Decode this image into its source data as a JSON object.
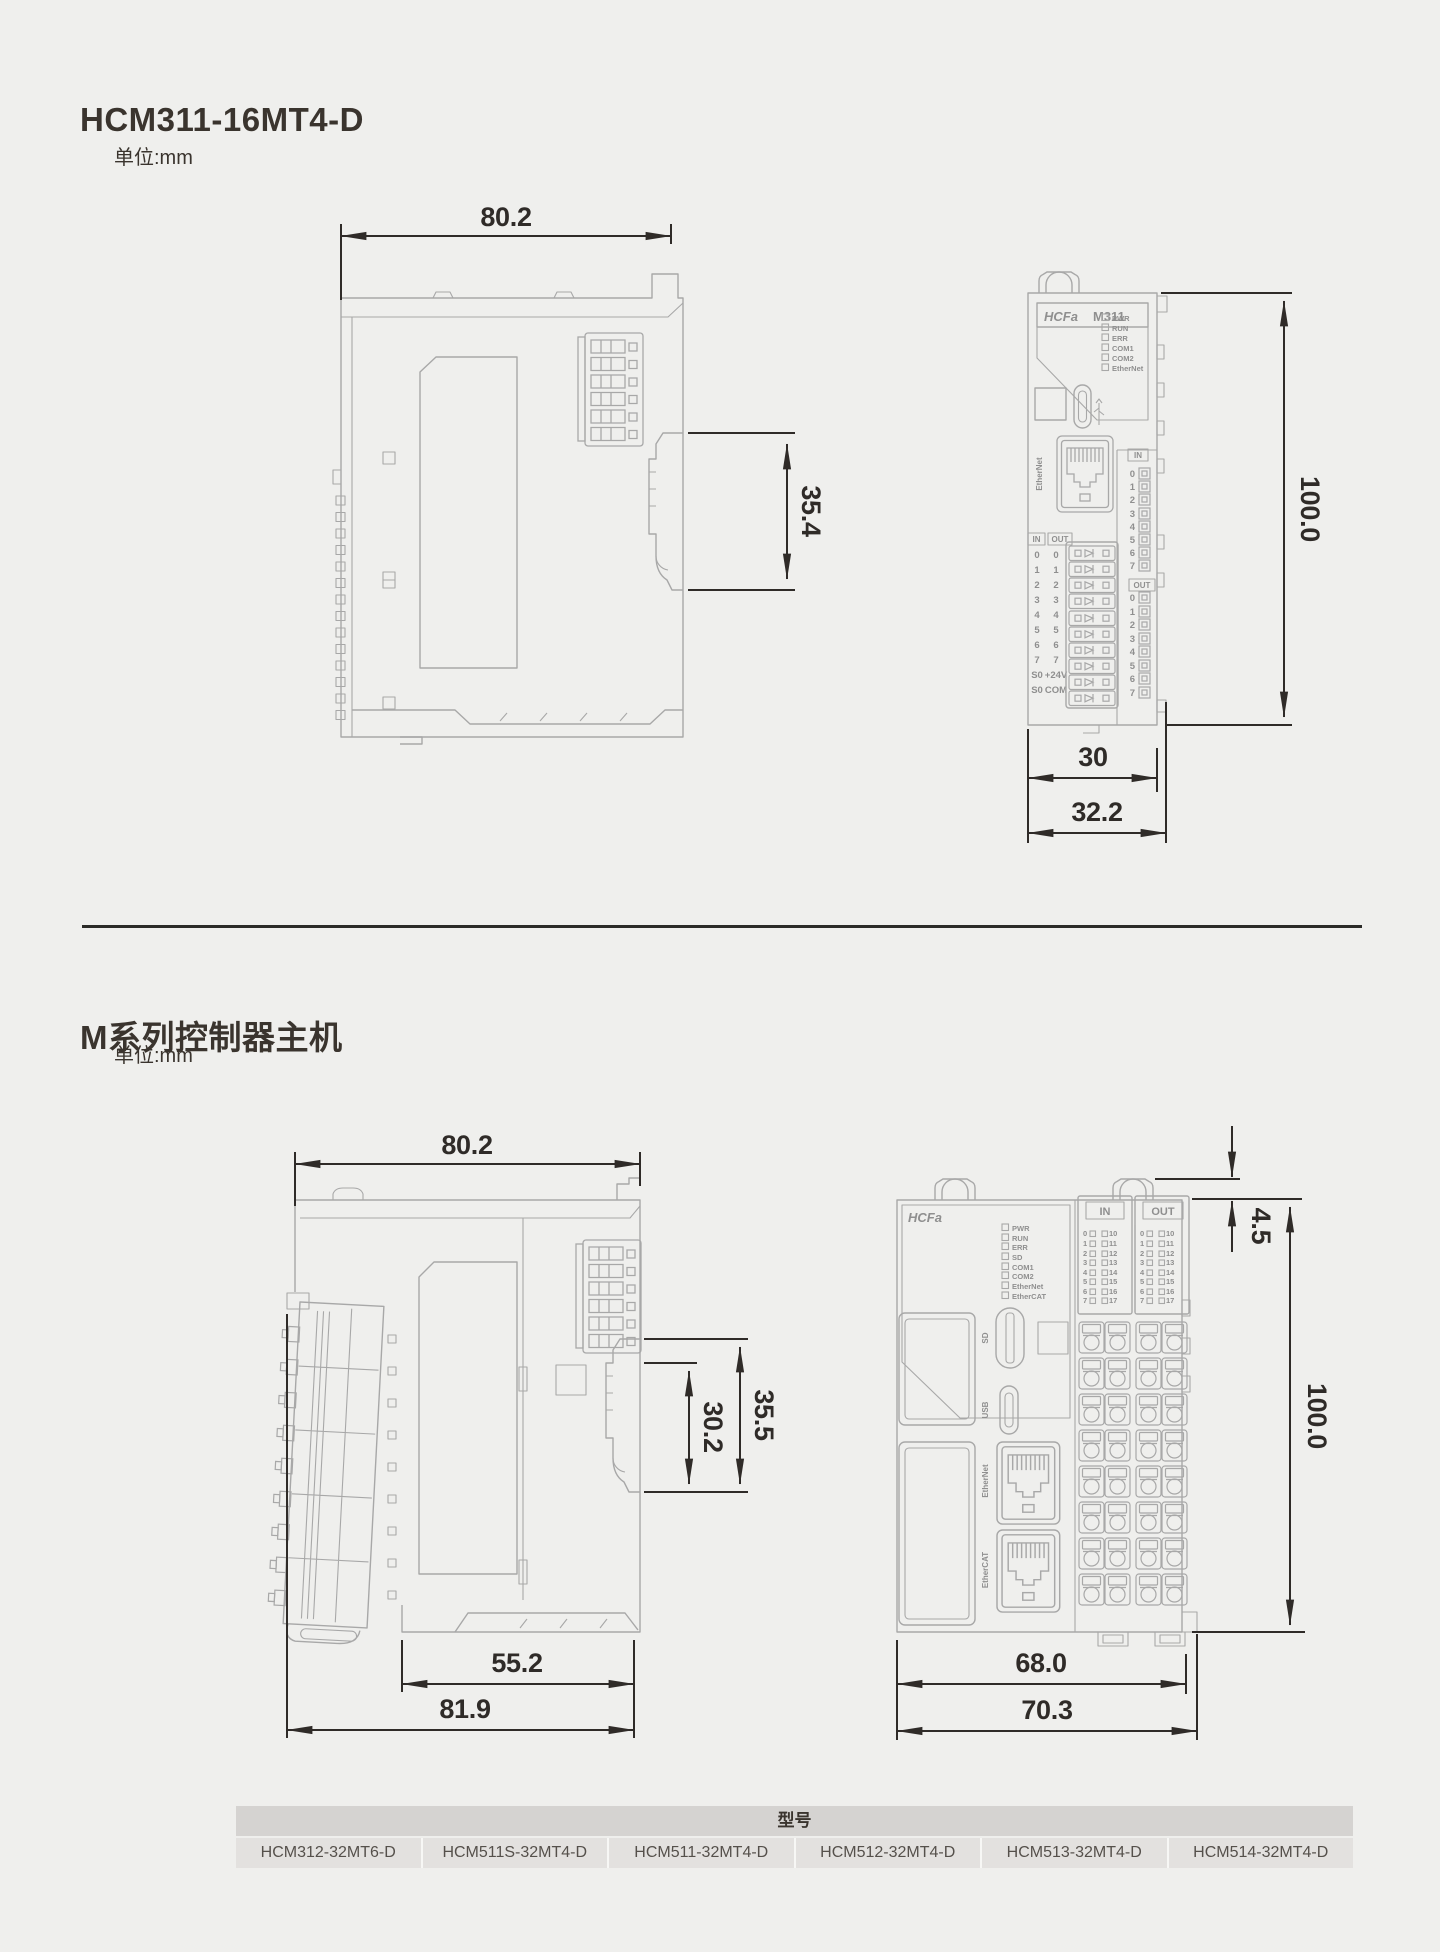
{
  "s1": {
    "title": "HCM311-16MT4-D",
    "unit": "单位:mm",
    "side": {
      "w": "80.2",
      "clip": "35.4"
    },
    "front": {
      "logo": "HCFa",
      "model": "M311",
      "leds": [
        "PWR",
        "RUN",
        "ERR",
        "COM1",
        "COM2",
        "EtherNet"
      ],
      "port": "EtherNet",
      "hdr_in": "IN",
      "hdr_out": "OUT",
      "rows": [
        [
          "0",
          "0"
        ],
        [
          "1",
          "1"
        ],
        [
          "2",
          "2"
        ],
        [
          "3",
          "3"
        ],
        [
          "4",
          "4"
        ],
        [
          "5",
          "5"
        ],
        [
          "6",
          "6"
        ],
        [
          "7",
          "7"
        ],
        [
          "S0",
          "+24V"
        ],
        [
          "S0",
          "COM"
        ]
      ],
      "rin": "IN",
      "rout": "OUT",
      "nums": [
        "0",
        "1",
        "2",
        "3",
        "4",
        "5",
        "6",
        "7"
      ],
      "h": "100.0",
      "w": "30",
      "wt": "32.2"
    }
  },
  "s2": {
    "title": "M系列控制器主机",
    "unit": "单位:mm",
    "side": {
      "w": "80.2",
      "clip_in": "30.2",
      "clip": "35.5",
      "body": "55.2",
      "total": "81.9"
    },
    "front": {
      "logo": "HCFa",
      "leds": [
        "PWR",
        "RUN",
        "ERR",
        "SD",
        "COM1",
        "COM2",
        "EtherNet",
        "EtherCAT"
      ],
      "sd": "SD",
      "usb": "USB",
      "eth": "EtherNet",
      "ecat": "EtherCAT",
      "hdr_in": "IN",
      "hdr_out": "OUT",
      "io_l": [
        "0",
        "1",
        "2",
        "3",
        "4",
        "5",
        "6",
        "7"
      ],
      "io_r": [
        "10",
        "11",
        "12",
        "13",
        "14",
        "15",
        "16",
        "17"
      ],
      "tab": "4.5",
      "h": "100.0",
      "w": "68.0",
      "total": "70.3"
    }
  },
  "table": {
    "header": "型号",
    "models": [
      "HCM312-32MT6-D",
      "HCM511S-32MT4-D",
      "HCM511-32MT4-D",
      "HCM512-32MT4-D",
      "HCM513-32MT4-D",
      "HCM514-32MT4-D"
    ]
  }
}
